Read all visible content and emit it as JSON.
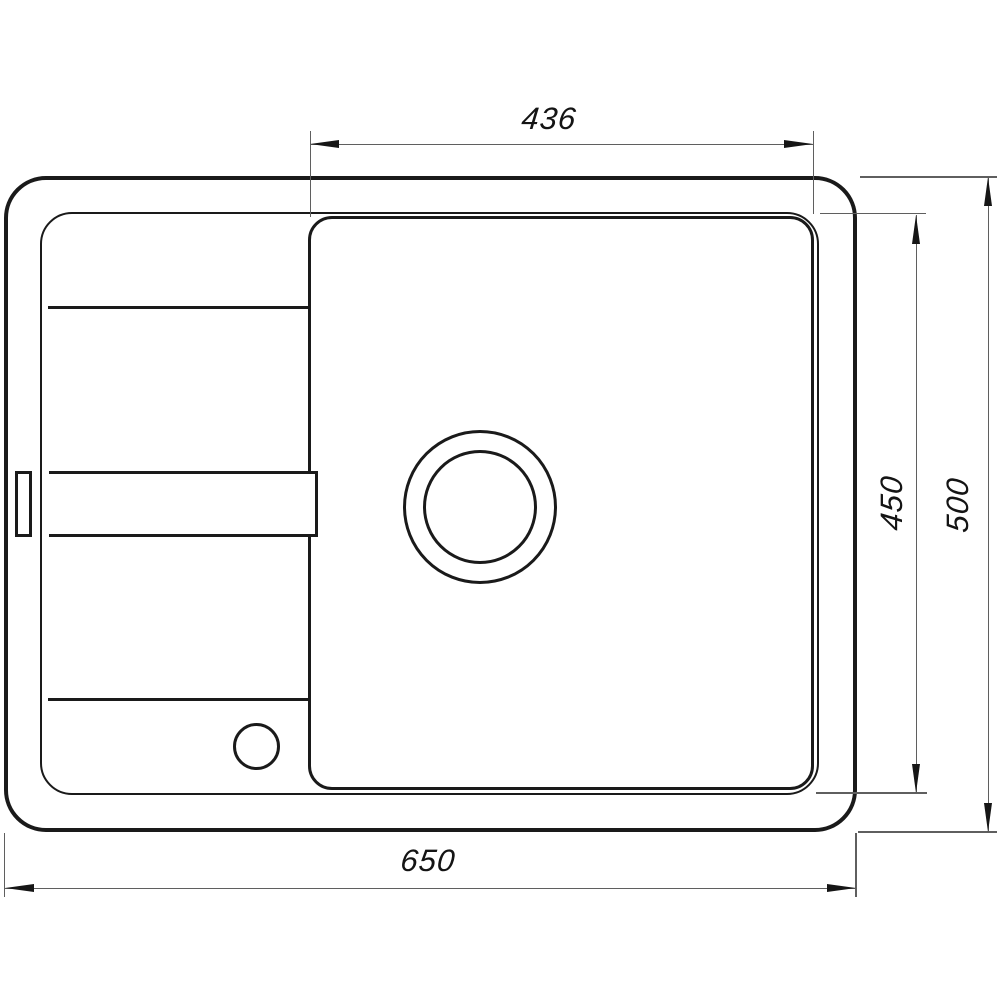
{
  "diagram": {
    "type": "technical-drawing",
    "subject": "kitchen sink with drainboard, top view",
    "dimensions": [
      {
        "id": "basin-width",
        "label": "436",
        "orientation": "horizontal",
        "position": "top"
      },
      {
        "id": "basin-depth",
        "label": "450",
        "orientation": "vertical",
        "position": "right-inner"
      },
      {
        "id": "overall-depth",
        "label": "500",
        "orientation": "vertical",
        "position": "right-outer"
      },
      {
        "id": "overall-width",
        "label": "650",
        "orientation": "horizontal",
        "position": "bottom"
      }
    ],
    "colors": {
      "outline": "#1a1a1a",
      "dimension_line": "#5f5f5f",
      "text": "#141414",
      "background": "#ffffff"
    }
  }
}
